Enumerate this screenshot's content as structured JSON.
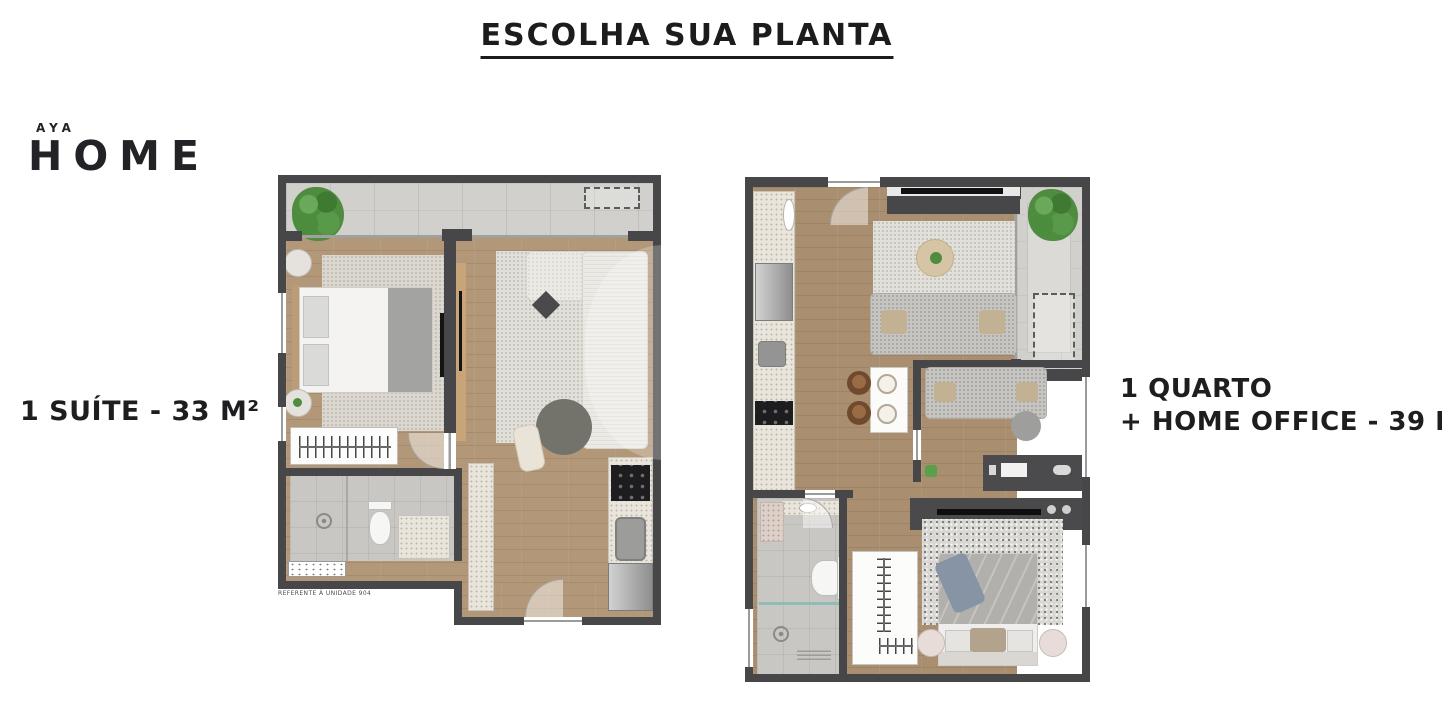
{
  "title": "ESCOLHA SUA PLANTA",
  "logo": {
    "top": "AYA",
    "main": "HOME"
  },
  "plans": [
    {
      "label": "1 SUÍTE - 33 M²",
      "note": "REFERENTE À UNIDADE 904",
      "rooms": [
        "varanda",
        "suíte",
        "banheiro",
        "closet",
        "estar",
        "cozinha"
      ]
    },
    {
      "label_line1": "1 QUARTO",
      "label_line2": "+ HOME OFFICE - 39 M²",
      "rooms": [
        "varanda",
        "estar",
        "cozinha",
        "home office",
        "quarto",
        "closet",
        "banheiro"
      ]
    }
  ],
  "colors": {
    "background": "#ffffff",
    "text": "#1c1c1e",
    "wall": "#47474a",
    "wood_left_plan": "#b29878",
    "wood_right_plan": "#a98f70",
    "balcony_tile": "#d1d0cc",
    "plant_green": "#4f8c3f"
  }
}
